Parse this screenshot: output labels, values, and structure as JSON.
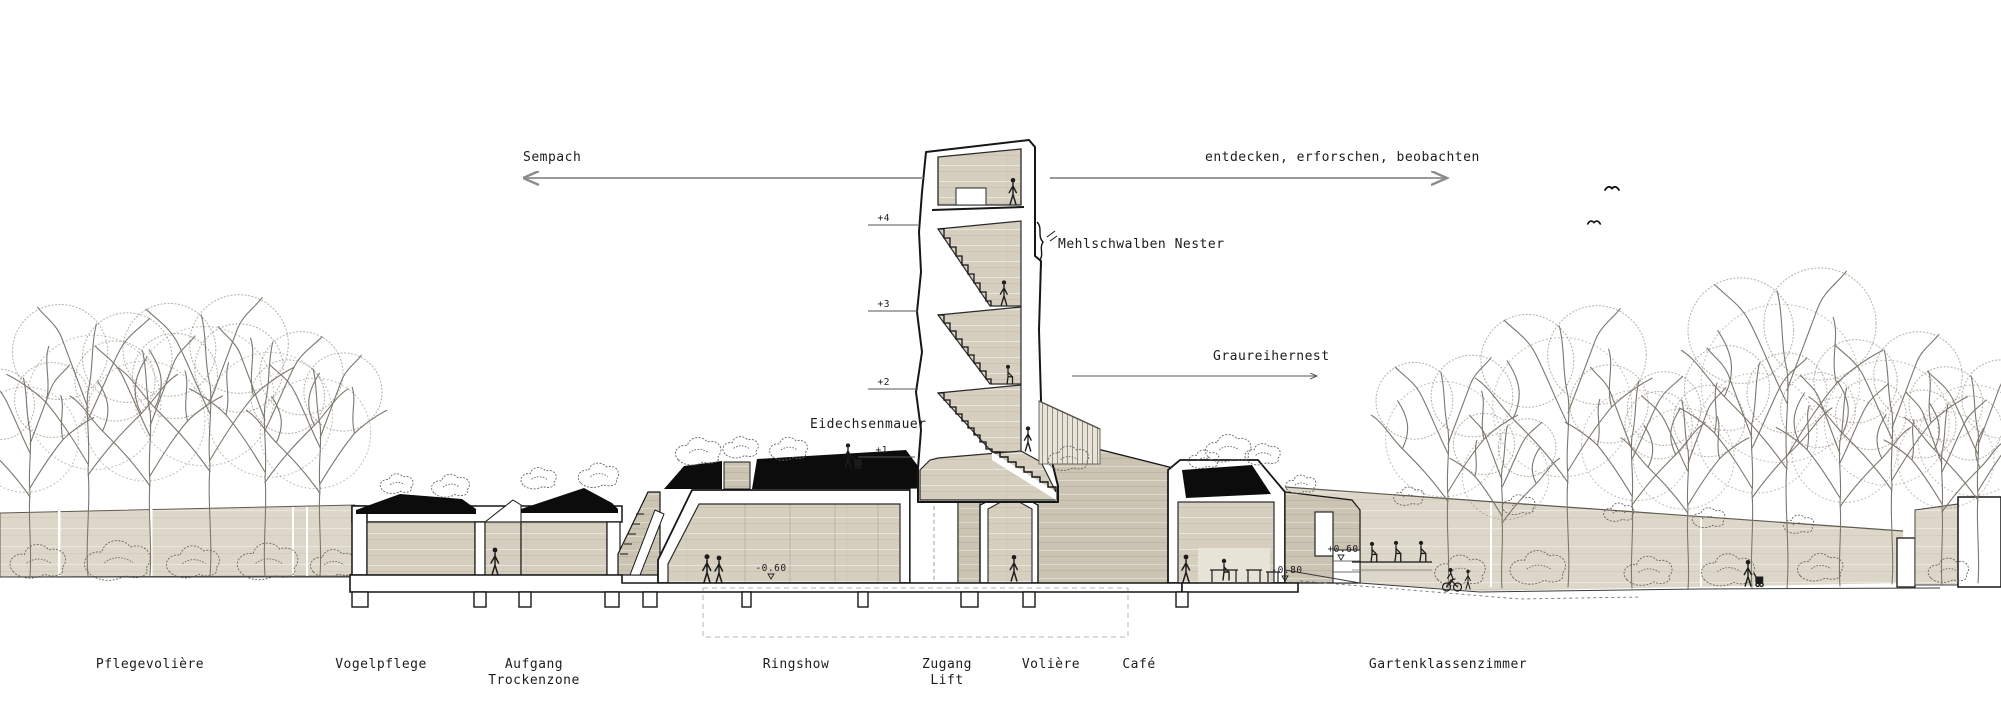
{
  "drawing": {
    "type": "architectural-section",
    "annotations": {
      "district_left": "Sempach",
      "activity_right": "entdecken, erforschen, beobachten",
      "nest_label": "Mehlschwalben Nester",
      "heron_label": "Graureihernest",
      "lizard_wall_label": "Eidechsenmauer"
    },
    "levels": {
      "l4": "+4",
      "l3": "+3",
      "l2": "+2",
      "l1": "+1"
    },
    "elevations": {
      "ringshow": "-0.60",
      "cafe": "-0.80",
      "terrace": "+0.60"
    },
    "rooms": [
      {
        "label": "Pflegevolière"
      },
      {
        "label": "Vogelpflege"
      },
      {
        "label": "Aufgang",
        "label2": "Trockenzone"
      },
      {
        "label": "Ringshow"
      },
      {
        "label": "Zugang",
        "label2": "Lift"
      },
      {
        "label": "Volière"
      },
      {
        "label": "Café"
      },
      {
        "label": "Gartenklassenzimmer"
      }
    ],
    "colors": {
      "wood_beige": "#d6cfc0",
      "dark_beige": "#cbc4b3",
      "band_beige": "#ddd7c9",
      "roof_black": "#0c0c0c",
      "outline": "#161616",
      "tree": "#7d776c",
      "arrow_gray": "#9a9a9a"
    }
  }
}
